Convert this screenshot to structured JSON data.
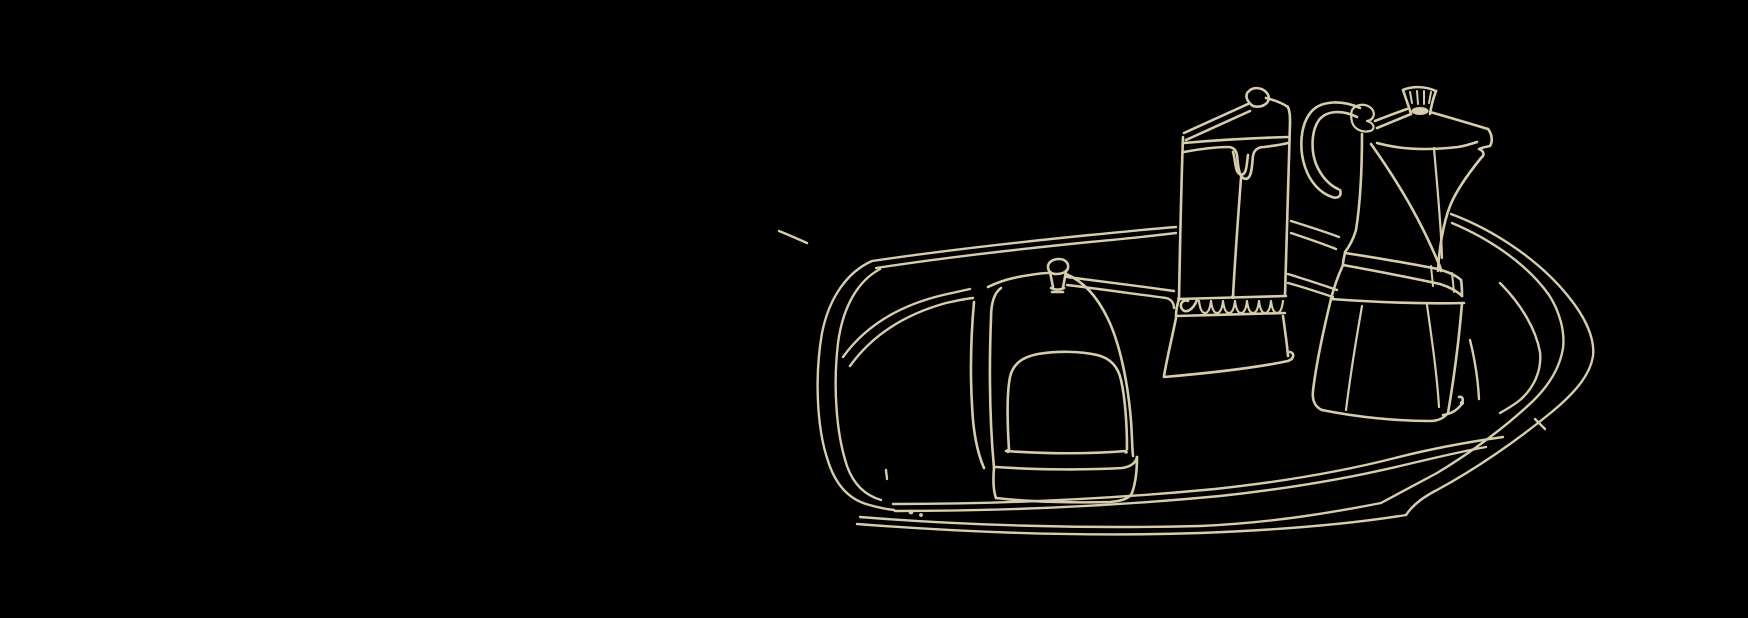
{
  "artwork": {
    "description": "Continuous one-line contour sketch, cream ink on black: an oval breakfast tray holding a lidded canister with a knob, a tall carton-like pitcher with a hanging drip and scalloped trim, and an octagonal stovetop moka pot",
    "style": "hand-drawn single-line illustration",
    "palette": {
      "background": "#000000",
      "line": "#d6cdad"
    },
    "objects": [
      {
        "id": "tray",
        "label": "oval serving tray"
      },
      {
        "id": "covered-dish",
        "label": "lidded canister with knob"
      },
      {
        "id": "drip-pitcher",
        "label": "carton pitcher with drip and scalloped band"
      },
      {
        "id": "moka-pot",
        "label": "octagonal moka pot with handle and spout"
      }
    ]
  }
}
